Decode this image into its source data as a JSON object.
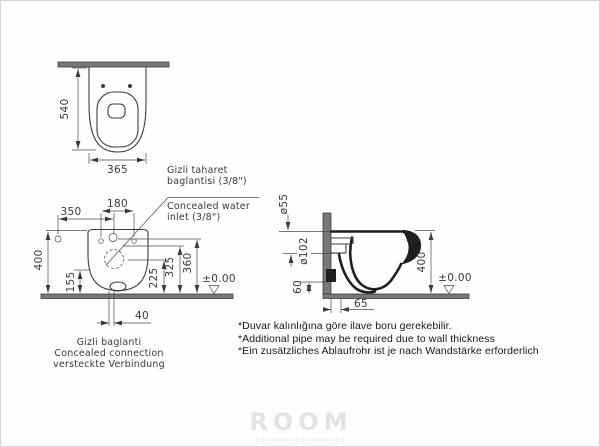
{
  "watermark": {
    "brand": "ROOM"
  },
  "top_view": {
    "dim_height": "540",
    "dim_width": "365"
  },
  "front_view": {
    "dim_inlet_offset": "350",
    "dim_bolt_spacing": "180",
    "dim_height": "400",
    "dim_h1": "155",
    "dim_h2": "225",
    "dim_h3": "325",
    "dim_h4": "360",
    "dim_outlet_gap": "40",
    "floor_level": "±0.00"
  },
  "side_view": {
    "dia_water_inlet": "ø55",
    "dia_waste_outlet": "ø102",
    "dim_h_outlet": "60",
    "dim_height": "400",
    "dim_wall_offset": "65",
    "floor_level": "±0.00"
  },
  "inlet_label": {
    "tr_line1": "Gizli taharet",
    "tr_line2": "baglantisi (3/8\")",
    "en_line1": "Concealed water",
    "en_line2": "inlet (3/8\")"
  },
  "connection_label": {
    "tr": "Gizli baglanti",
    "en": "Concealed connection",
    "de": "versteckte Verbindung"
  },
  "notes": {
    "tr": "*Duvar kalınlığına göre ilave boru gerekebilir.",
    "en": "*Additional pipe may be required due to wall thickness",
    "de": "*Ein zusätzliches Ablaufrohr ist je nach Wandstärke erforderlich"
  }
}
